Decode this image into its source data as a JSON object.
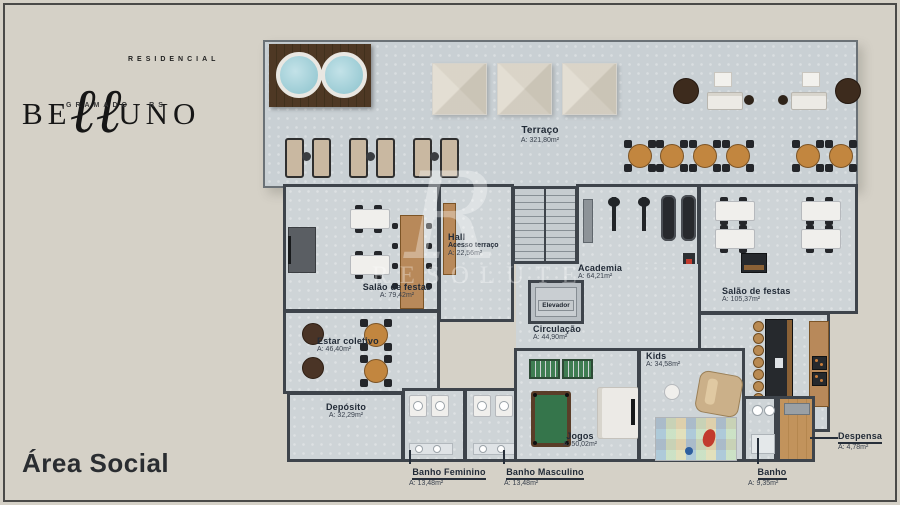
{
  "brand": {
    "residencial": "RESIDENCIAL",
    "name_start": "BE",
    "name_script": "ℓℓ",
    "name_end": "UNO",
    "location": "GRAMADO - RS"
  },
  "page_title": "Área Social",
  "watermark": {
    "mark": "R",
    "text": "RESOLUTE"
  },
  "rooms": {
    "terraco": {
      "name": "Terraço",
      "area": "A: 321,80m²"
    },
    "hall": {
      "name": "Hall",
      "subtitle": "Acesso terraço",
      "area": "A: 22,56m²"
    },
    "salao_festas_1": {
      "name": "Salão de festas",
      "area": "A: 79,42m²"
    },
    "academia": {
      "name": "Academia",
      "area": "A: 64,21m²"
    },
    "elevador": {
      "name": "Elevador"
    },
    "circulacao": {
      "name": "Circulação",
      "area": "A: 44,90m²"
    },
    "salao_festas_2": {
      "name": "Salão de festas",
      "area": "A: 105,37m²"
    },
    "estar_coletivo": {
      "name": "Estar coletivo",
      "area": "A: 46,40m²"
    },
    "kids": {
      "name": "Kids",
      "area": "A: 34,58m²"
    },
    "deposito": {
      "name": "Depósito",
      "area": "A: 32,29m²"
    },
    "jogos": {
      "name": "Jogos",
      "area": "A: 50,02m²"
    },
    "banho_feminino": {
      "name": "Banho Feminino",
      "area": "A: 13,48m²"
    },
    "banho_masculino": {
      "name": "Banho Masculino",
      "area": "A: 13,48m²"
    },
    "banho": {
      "name": "Banho",
      "area": "A: 9,35m²"
    },
    "despensa": {
      "name": "Despensa",
      "area": "A: 4,78m²"
    }
  },
  "colors": {
    "background": "#d5d1c7",
    "floor": "#ced4d7",
    "walls": "#3e444b",
    "label_text": "#222b37",
    "deck_wood": "#4e3824",
    "water": "#a5d4dc",
    "table_wood": "#c2863f",
    "pool_green": "#35754b"
  }
}
